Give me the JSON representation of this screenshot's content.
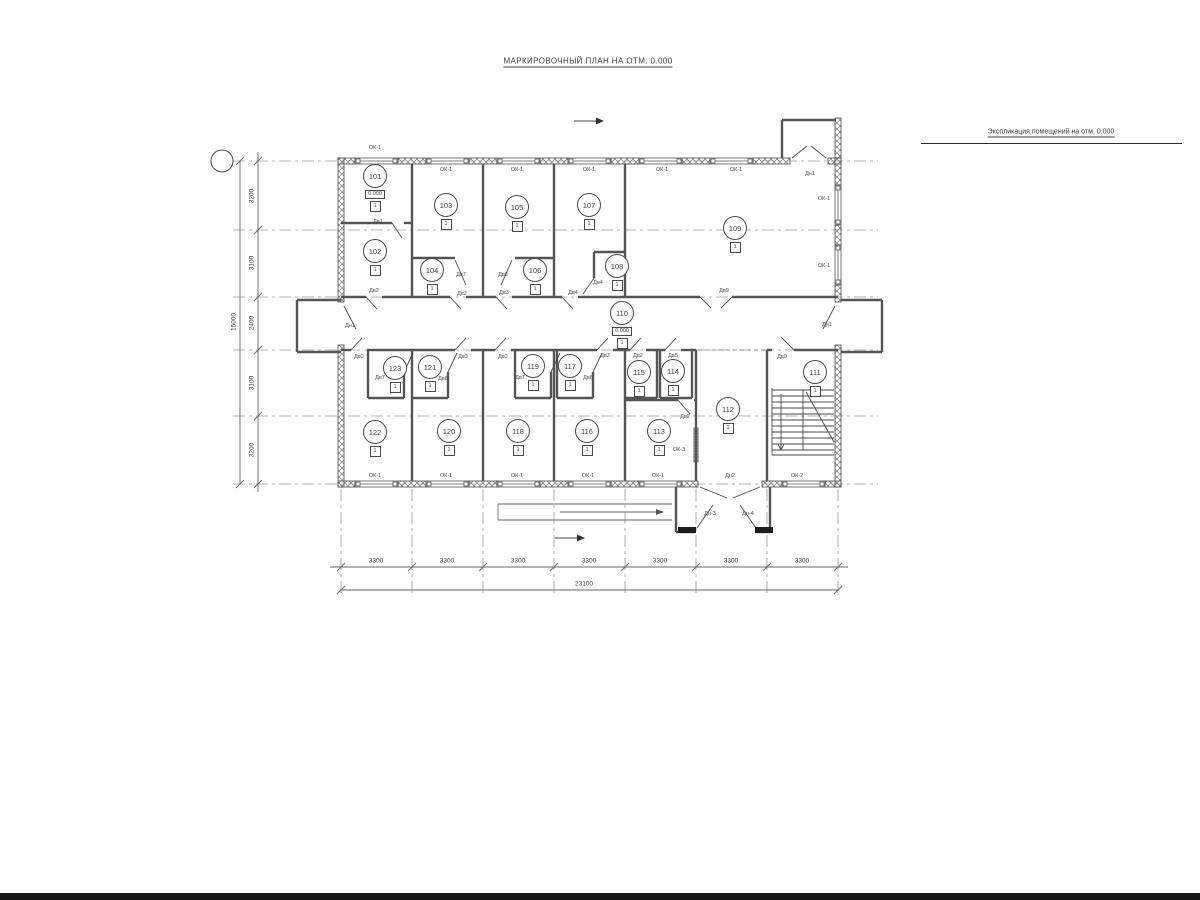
{
  "sheet": {
    "title": "МАРКИРОВОЧНЫЙ ПЛАН НА ОТМ. 0.000"
  },
  "plan": {
    "marker_glyph": "1",
    "rooms": [
      {
        "n": "101",
        "x": 375,
        "y": 176,
        "level": "0.000"
      },
      {
        "n": "102",
        "x": 375,
        "y": 251
      },
      {
        "n": "103",
        "x": 446,
        "y": 205
      },
      {
        "n": "104",
        "x": 432,
        "y": 270
      },
      {
        "n": "105",
        "x": 517,
        "y": 207
      },
      {
        "n": "106",
        "x": 535,
        "y": 270
      },
      {
        "n": "107",
        "x": 589,
        "y": 205
      },
      {
        "n": "108",
        "x": 617,
        "y": 266
      },
      {
        "n": "109",
        "x": 735,
        "y": 228
      },
      {
        "n": "110",
        "x": 622,
        "y": 313,
        "level": "0.000"
      },
      {
        "n": "111",
        "x": 815,
        "y": 372
      },
      {
        "n": "112",
        "x": 728,
        "y": 409
      },
      {
        "n": "113",
        "x": 659,
        "y": 431
      },
      {
        "n": "114",
        "x": 673,
        "y": 371
      },
      {
        "n": "115",
        "x": 639,
        "y": 372
      },
      {
        "n": "116",
        "x": 587,
        "y": 431
      },
      {
        "n": "117",
        "x": 570,
        "y": 366
      },
      {
        "n": "118",
        "x": 518,
        "y": 431
      },
      {
        "n": "119",
        "x": 533,
        "y": 366
      },
      {
        "n": "120",
        "x": 449,
        "y": 431
      },
      {
        "n": "121",
        "x": 430,
        "y": 367
      },
      {
        "n": "122",
        "x": 375,
        "y": 432
      },
      {
        "n": "123",
        "x": 395,
        "y": 368
      }
    ],
    "labels": [
      {
        "t": "ОК-1",
        "x": 375,
        "y": 148
      },
      {
        "t": "ОК-1",
        "x": 446,
        "y": 170
      },
      {
        "t": "ОК-1",
        "x": 517,
        "y": 170
      },
      {
        "t": "ОК-1",
        "x": 589,
        "y": 170
      },
      {
        "t": "ОК-1",
        "x": 662,
        "y": 170
      },
      {
        "t": "ОК-1",
        "x": 736,
        "y": 170
      },
      {
        "t": "Дн1",
        "x": 810,
        "y": 174
      },
      {
        "t": "ОК-1",
        "x": 824,
        "y": 199
      },
      {
        "t": "ОК-1",
        "x": 824,
        "y": 266
      },
      {
        "t": "Дв1",
        "x": 378,
        "y": 222
      },
      {
        "t": "Дв2",
        "x": 374,
        "y": 291
      },
      {
        "t": "Дв7",
        "x": 461,
        "y": 275
      },
      {
        "t": "Дв2",
        "x": 462,
        "y": 294
      },
      {
        "t": "Дв8",
        "x": 503,
        "y": 275
      },
      {
        "t": "Дв3",
        "x": 504,
        "y": 293
      },
      {
        "t": "Дв4",
        "x": 573,
        "y": 293
      },
      {
        "t": "Дв4",
        "x": 598,
        "y": 283
      },
      {
        "t": "Дв9",
        "x": 724,
        "y": 291
      },
      {
        "t": "Дн1",
        "x": 350,
        "y": 326
      },
      {
        "t": "Дн1",
        "x": 827,
        "y": 325
      },
      {
        "t": "Дв2",
        "x": 359,
        "y": 357
      },
      {
        "t": "Дв3",
        "x": 463,
        "y": 357
      },
      {
        "t": "Дв2",
        "x": 503,
        "y": 357
      },
      {
        "t": "Дв3",
        "x": 605,
        "y": 356
      },
      {
        "t": "Дв2",
        "x": 638,
        "y": 356
      },
      {
        "t": "Дв5",
        "x": 673,
        "y": 356
      },
      {
        "t": "Дв9",
        "x": 782,
        "y": 357
      },
      {
        "t": "Дв7",
        "x": 380,
        "y": 378
      },
      {
        "t": "Дв8",
        "x": 443,
        "y": 379
      },
      {
        "t": "Дв7",
        "x": 520,
        "y": 378
      },
      {
        "t": "Дв8",
        "x": 588,
        "y": 378
      },
      {
        "t": "Дв2",
        "x": 685,
        "y": 417
      },
      {
        "t": "ОК-1",
        "x": 375,
        "y": 476
      },
      {
        "t": "ОК-1",
        "x": 446,
        "y": 476
      },
      {
        "t": "ОК-1",
        "x": 517,
        "y": 476
      },
      {
        "t": "ОК-1",
        "x": 588,
        "y": 476
      },
      {
        "t": "ОК-1",
        "x": 658,
        "y": 476
      },
      {
        "t": "ОК-3",
        "x": 679,
        "y": 450
      },
      {
        "t": "Дн2",
        "x": 730,
        "y": 476
      },
      {
        "t": "ОК-2",
        "x": 797,
        "y": 476
      },
      {
        "t": "Дн-3",
        "x": 710,
        "y": 514
      },
      {
        "t": "Дн-4",
        "x": 748,
        "y": 514
      }
    ],
    "dim_labels": [
      {
        "t": "3300",
        "x": 376,
        "y": 561
      },
      {
        "t": "3300",
        "x": 447,
        "y": 561
      },
      {
        "t": "3300",
        "x": 518,
        "y": 561
      },
      {
        "t": "3300",
        "x": 589,
        "y": 561
      },
      {
        "t": "3300",
        "x": 660,
        "y": 561
      },
      {
        "t": "3300",
        "x": 731,
        "y": 561
      },
      {
        "t": "3300",
        "x": 802,
        "y": 561
      },
      {
        "t": "23100",
        "x": 584,
        "y": 584
      },
      {
        "t": "3200",
        "x": 252,
        "y": 196,
        "r": -90
      },
      {
        "t": "3100",
        "x": 252,
        "y": 263,
        "r": -90
      },
      {
        "t": "2400",
        "x": 252,
        "y": 323,
        "r": -90
      },
      {
        "t": "3100",
        "x": 252,
        "y": 383,
        "r": -90
      },
      {
        "t": "3200",
        "x": 252,
        "y": 450,
        "r": -90
      },
      {
        "t": "15000",
        "x": 234,
        "y": 322,
        "r": -90
      }
    ],
    "axis_letters": [
      {
        "t": "Е",
        "y": 161
      },
      {
        "t": "Д",
        "y": 230
      },
      {
        "t": "Г",
        "y": 297
      },
      {
        "t": "В",
        "y": 350
      },
      {
        "t": "Б",
        "y": 416
      },
      {
        "t": "А",
        "y": 484
      }
    ],
    "axis_numbers": [
      {
        "t": "1",
        "x": 341
      },
      {
        "t": "2",
        "x": 412
      },
      {
        "t": "3",
        "x": 483
      },
      {
        "t": "4",
        "x": 554
      },
      {
        "t": "5",
        "x": 625
      },
      {
        "t": "6",
        "x": 696
      },
      {
        "t": "7",
        "x": 767
      },
      {
        "t": "8",
        "x": 838
      }
    ],
    "section_marks": [
      {
        "t": "1",
        "x": 584,
        "y": 112
      },
      {
        "t": "1",
        "x": 565,
        "y": 529
      }
    ]
  },
  "schedule": {
    "title": "Экспликация помещений на отм. 0.000",
    "columns": [
      "Номер. пом.",
      "Наименование",
      "Площадь кв.м",
      "Кат."
    ],
    "rows": [
      [
        "101",
        "Бойлерная",
        "6.44",
        ""
      ],
      [
        "102",
        "Тех. помещение",
        "13.10",
        ""
      ],
      [
        "103",
        "Номер для проживания",
        "16.44",
        ""
      ],
      [
        "104",
        "Сан. узел",
        "2.74",
        ""
      ],
      [
        "105",
        "Номер для проживания",
        "16.44",
        ""
      ],
      [
        "106",
        "Сан. узел",
        "2.74",
        ""
      ],
      [
        "107",
        "Номер для проживания",
        "19.56",
        ""
      ],
      [
        "108",
        "Сан. узел",
        "4.45",
        ""
      ],
      [
        "109",
        "Комната рекреации",
        "56.16",
        ""
      ],
      [
        "110",
        "Коридор",
        "51.74",
        ""
      ],
      [
        "111",
        "Лестн. клетка",
        "21.56",
        ""
      ],
      [
        "112",
        "Холл",
        "19.07",
        ""
      ],
      [
        "113",
        "Хоз. помещение",
        "12.30",
        ""
      ],
      [
        "114",
        "Сан. узел",
        "3.74",
        ""
      ],
      [
        "115",
        "Сан. узел",
        "2.93",
        ""
      ],
      [
        "116",
        "Номер для проживания",
        "16.44",
        ""
      ],
      [
        "117",
        "Сан. узел",
        "2.74",
        ""
      ],
      [
        "118",
        "Номер для проживания",
        "16.44",
        ""
      ],
      [
        "119",
        "Сан. узел",
        "2.74",
        ""
      ],
      [
        "120",
        "Номер для проживания",
        "16.44",
        ""
      ],
      [
        "121",
        "Сан. узел",
        "2.74",
        ""
      ],
      [
        "122",
        "Номер для проживания",
        "16.44",
        ""
      ],
      [
        "123",
        "Сан. узел",
        "2.74",
        ""
      ]
    ],
    "total_label": "Итого",
    "total_value": "326.13"
  }
}
